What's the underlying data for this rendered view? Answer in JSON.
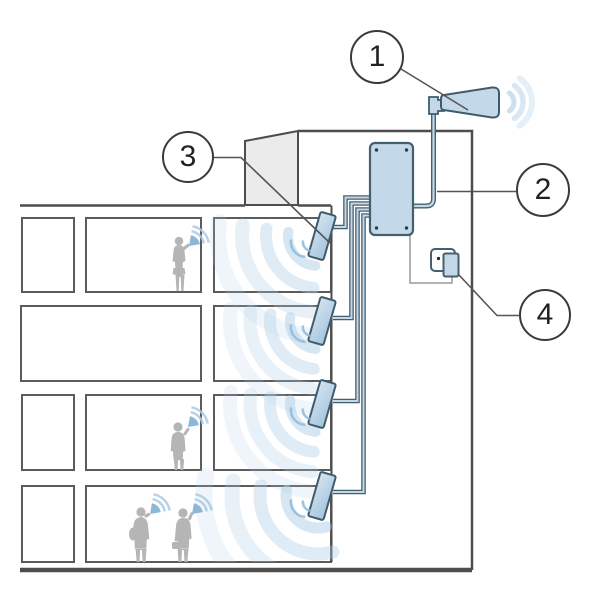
{
  "diagram": {
    "callouts": [
      {
        "label": "1"
      },
      {
        "label": "2"
      },
      {
        "label": "3"
      },
      {
        "label": "4"
      }
    ],
    "colors": {
      "component_fill": "#c3d9ea",
      "component_outline": "#3f5c6d",
      "building_line": "#4d4d4d",
      "signal_wave": "#aecde6",
      "silhouette": "#b5b5b5",
      "bulkhead_fill": "#ebebeb",
      "background": "#ffffff"
    }
  }
}
